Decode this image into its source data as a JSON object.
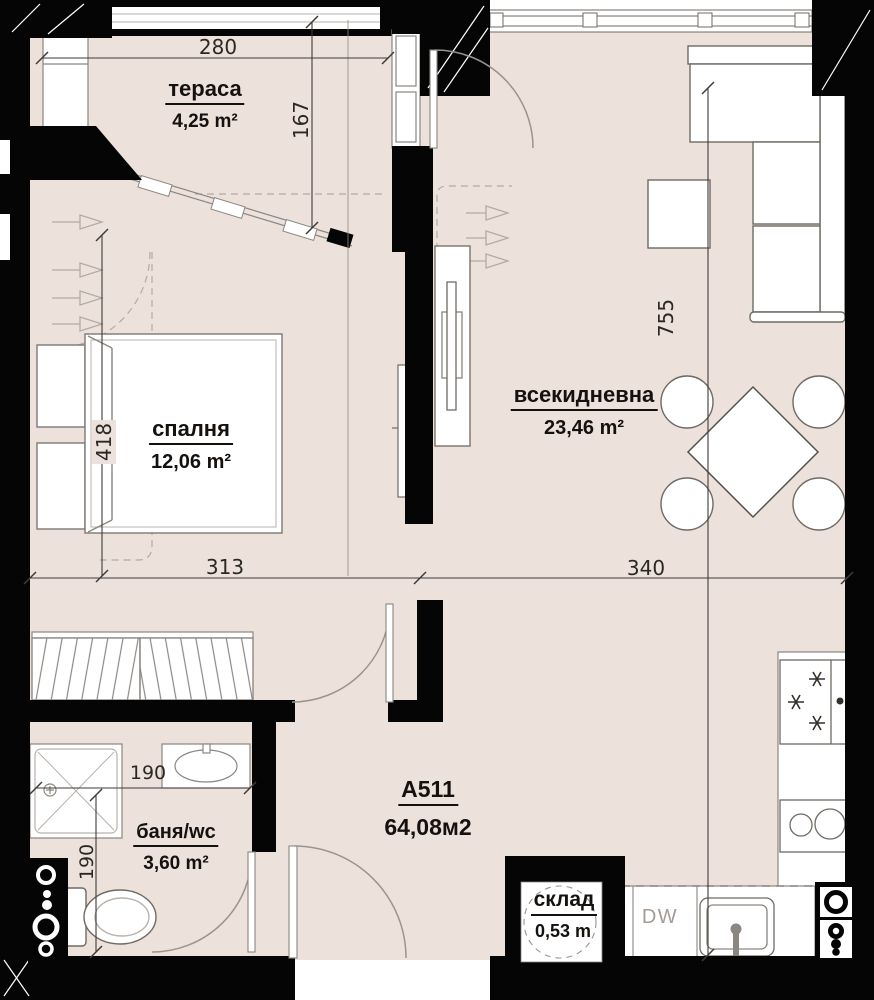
{
  "apartment": {
    "code": "A511",
    "total_area": "64,08м2"
  },
  "rooms": {
    "terrace": {
      "name": "тераса",
      "area": "4,25 m²"
    },
    "bedroom": {
      "name": "спалня",
      "area": "12,06 m²"
    },
    "living": {
      "name": "всекидневна",
      "area": "23,46 m²"
    },
    "bath": {
      "name": "баня/wc",
      "area": "3,60 m²"
    },
    "storage": {
      "name": "склад",
      "area": "0,53 m"
    }
  },
  "dimensions": {
    "terrace_width": "280",
    "terrace_depth": "167",
    "bedroom_depth": "418",
    "bedroom_width": "313",
    "living_width": "340",
    "living_depth": "755",
    "bath_width": "190",
    "bath_depth": "190"
  },
  "labels": {
    "dishwasher": "DW"
  },
  "colors": {
    "floor": "#EDE1DC",
    "wall": "#000000",
    "furniture_line": "#6F6A64",
    "dim_line": "#3F3B38"
  }
}
